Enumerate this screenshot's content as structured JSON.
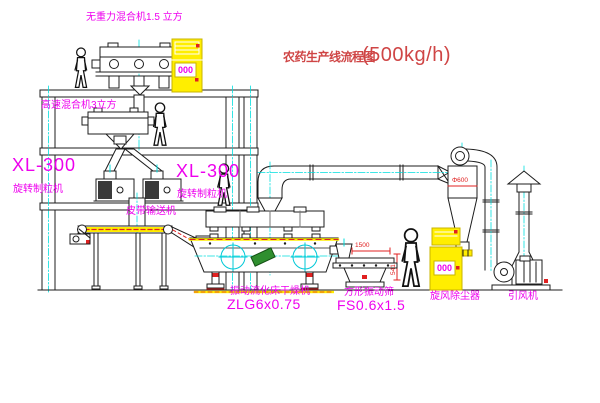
{
  "colors": {
    "magenta": "#ee00ee",
    "red": "#e02020",
    "title_red": "#cf4545",
    "cyan": "#00dede",
    "yellow": "#ffee00",
    "line": "#1c1c1c",
    "green": "#2f8f2f"
  },
  "title": {
    "name": "农药生产线流程图",
    "capacity": "(500kg/h)"
  },
  "equipment": {
    "mixer_top": {
      "label": "无重力混合机1.5 立方"
    },
    "mixer_mid": {
      "label": "高速混合机3立方"
    },
    "granulator": {
      "model": "XL-300",
      "name": "旋转制粒机"
    },
    "belt_conveyor": {
      "name": "皮带输送机"
    },
    "dryer": {
      "name": "振动流化床干燥机",
      "model": "ZLG6x0.75"
    },
    "sieve": {
      "name": "方形振动筛",
      "model": "FS0.6x1.5",
      "dim_width": "1500",
      "dim_height": "541"
    },
    "cyclone": {
      "name": "旋风除尘器",
      "dim": "Φ600"
    },
    "fan": {
      "name": "引风机"
    },
    "control_cabinet": {
      "display": "000"
    }
  }
}
